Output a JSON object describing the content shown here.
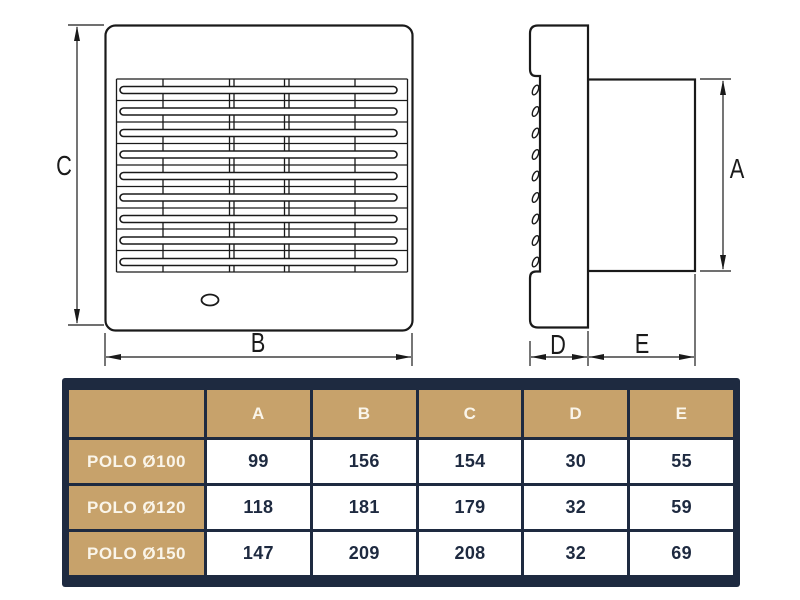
{
  "diagram": {
    "description": "Technical dimension drawing of POLO wall fan: front view and side view",
    "dimension_labels": {
      "a": "A",
      "b": "B",
      "c": "C",
      "d": "D",
      "e": "E"
    },
    "line_color": "#1a1a1a"
  },
  "table": {
    "column_headers": [
      "A",
      "B",
      "C",
      "D",
      "E"
    ],
    "rows": [
      {
        "model": "POLO Ø100",
        "values": [
          "99",
          "156",
          "154",
          "30",
          "55"
        ]
      },
      {
        "model": "POLO Ø120",
        "values": [
          "118",
          "181",
          "179",
          "32",
          "59"
        ]
      },
      {
        "model": "POLO Ø150",
        "values": [
          "147",
          "209",
          "208",
          "32",
          "69"
        ]
      }
    ],
    "colors": {
      "border_navy": "#1e2a40",
      "header_gold": "#c7a26b",
      "header_text": "#faf5ea",
      "data_text": "#1e2a40",
      "data_bg": "#ffffff"
    }
  }
}
